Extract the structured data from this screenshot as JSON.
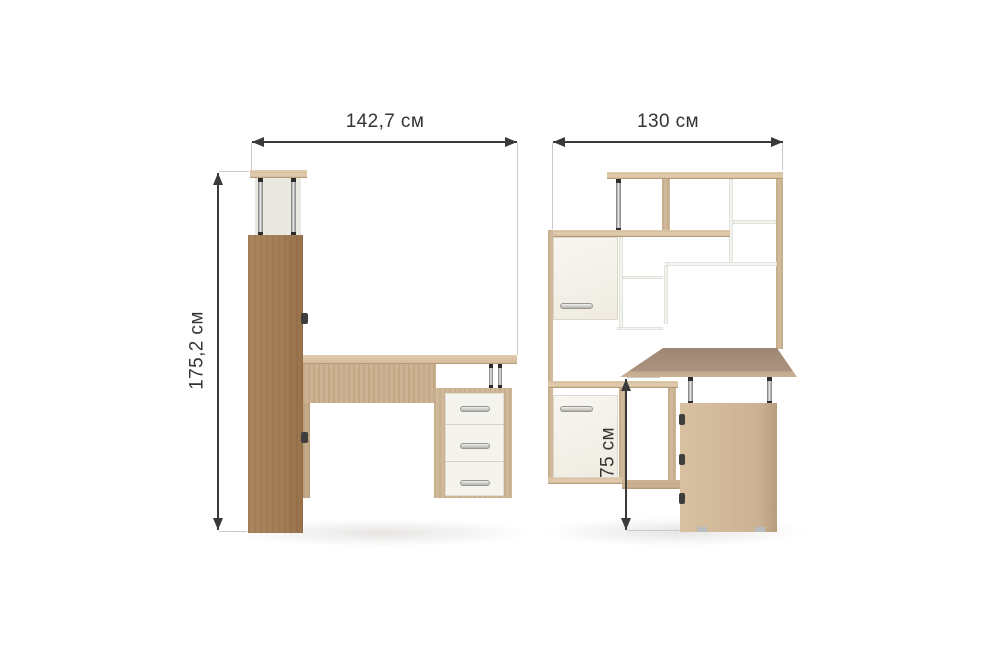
{
  "views": {
    "side": {
      "width_label": "142,7 см",
      "height_label": "175,2 см"
    },
    "front": {
      "width_label": "130 см",
      "desk_height_label": "75 см"
    }
  },
  "colors": {
    "background": "#ffffff",
    "dim_line": "#3a3a3a",
    "ext_line": "#c9c9c9",
    "text": "#343434",
    "wood_light": "#dcc6a7",
    "wood_mid": "#cdb494",
    "wood_dark": "#c0a685",
    "desk_surface_dark": "#a8917c",
    "white_front": "#f5f3ee",
    "chrome_hi": "#ececec",
    "chrome_lo": "#5f5f5f"
  }
}
